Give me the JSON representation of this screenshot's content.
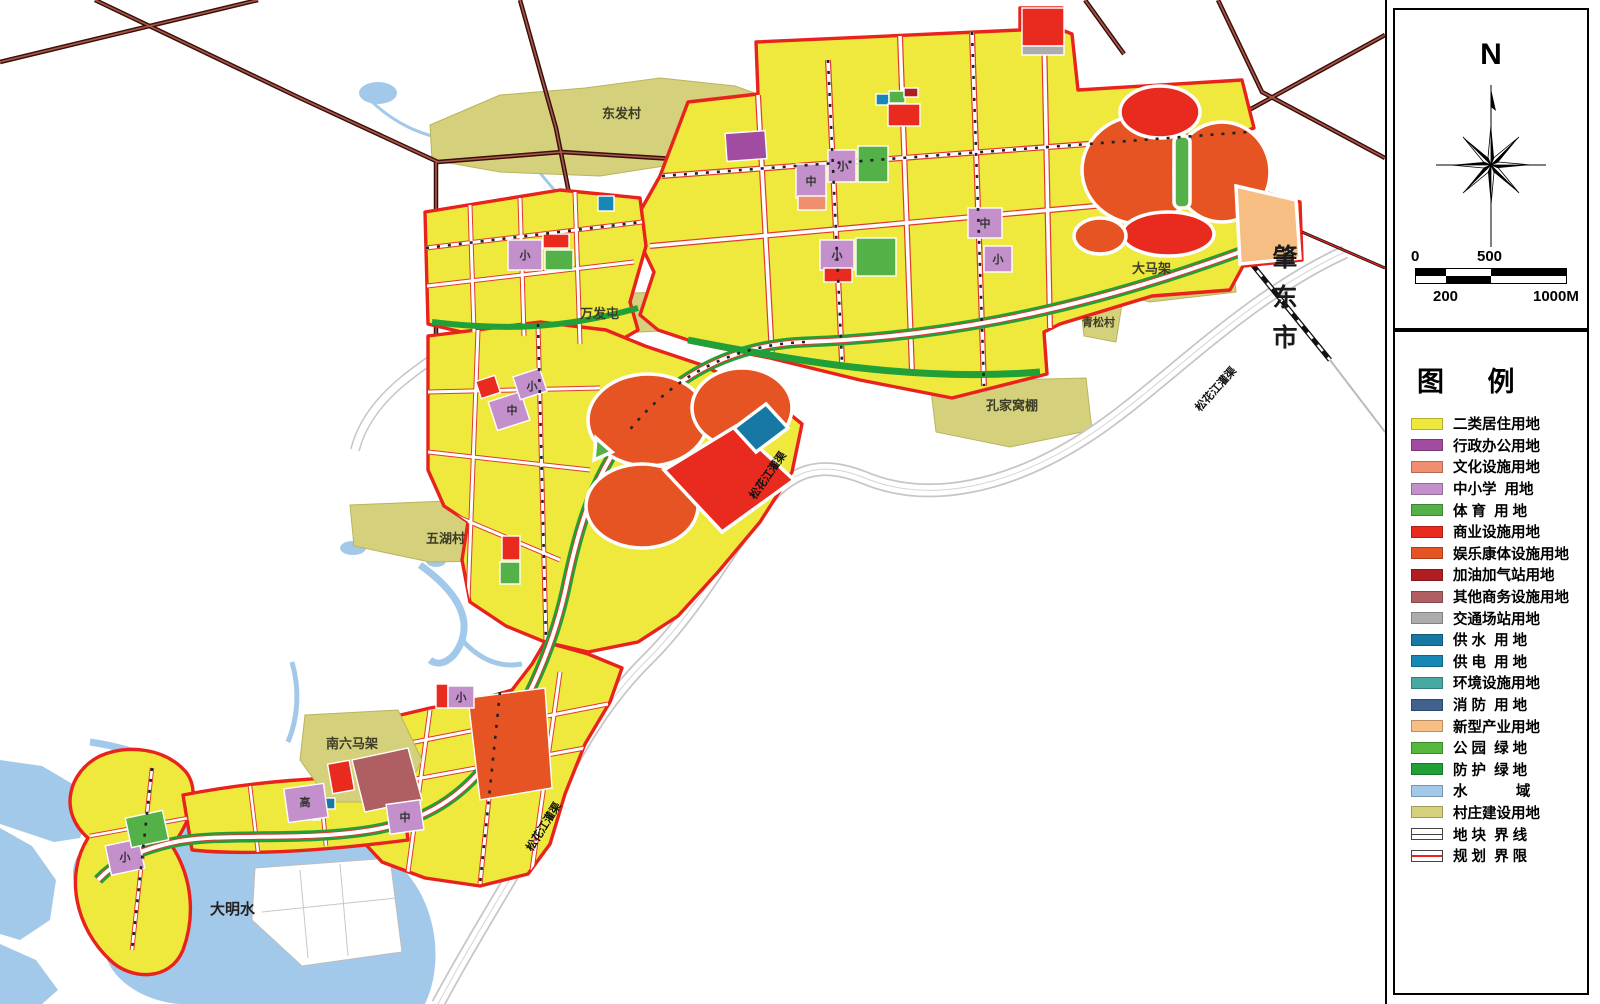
{
  "map": {
    "labels": [
      {
        "text": "东发村"
      },
      {
        "text": "万发屯"
      },
      {
        "text": "大马架"
      },
      {
        "text": "青松村"
      },
      {
        "text": "孔家窝棚"
      },
      {
        "text": "五湖村"
      },
      {
        "text": "南六马架"
      },
      {
        "text": "大明水"
      }
    ],
    "city_label": "肇东市",
    "canal_label": "松花江灌渠",
    "marker_primary": "小",
    "marker_middle": "中",
    "marker_high": "高"
  },
  "compass": {
    "north_label": "N"
  },
  "scalebar": {
    "tick_0": "0",
    "tick_500": "500",
    "tick_200": "200",
    "tick_1000": "1000M"
  },
  "legend": {
    "title": "图  例",
    "items": [
      {
        "label": "二类居住用地",
        "color": "#EFE93D",
        "style": "fill"
      },
      {
        "label": "行政办公用地",
        "color": "#A14CA0",
        "style": "fill"
      },
      {
        "label": "文化设施用地",
        "color": "#F08E70",
        "style": "fill"
      },
      {
        "label": "中小学  用地",
        "color": "#C490CC",
        "style": "fill"
      },
      {
        "label": "体 育  用 地",
        "color": "#53B148",
        "style": "fill"
      },
      {
        "label": "商业设施用地",
        "color": "#E92A1E",
        "style": "fill"
      },
      {
        "label": "娱乐康体设施用地",
        "color": "#E55422",
        "style": "fill"
      },
      {
        "label": "加油加气站用地",
        "color": "#B01E24",
        "style": "fill"
      },
      {
        "label": "其他商务设施用地",
        "color": "#AF5F62",
        "style": "fill"
      },
      {
        "label": "交通场站用地",
        "color": "#ACACAC",
        "style": "fill"
      },
      {
        "label": "供 水  用 地",
        "color": "#1779A3",
        "style": "fill"
      },
      {
        "label": "供 电  用 地",
        "color": "#1787B5",
        "style": "fill"
      },
      {
        "label": "环境设施用地",
        "color": "#47A9A2",
        "style": "fill"
      },
      {
        "label": "消 防  用 地",
        "color": "#41618F",
        "style": "fill"
      },
      {
        "label": "新型产业用地",
        "color": "#F6BE82",
        "style": "fill"
      },
      {
        "label": "公 园  绿 地",
        "color": "#55B73B",
        "style": "fill"
      },
      {
        "label": "防 护  绿 地",
        "color": "#21A038",
        "style": "fill"
      },
      {
        "label": "水            域",
        "color": "#A3C9EA",
        "style": "fill"
      },
      {
        "label": "村庄建设用地",
        "color": "#D5D07B",
        "style": "fill"
      },
      {
        "label": "地 块  界 线",
        "color": "#FFFFFF",
        "style": "line"
      },
      {
        "label": "规 划  界 限",
        "color": "#E8231D",
        "style": "redline"
      }
    ]
  }
}
